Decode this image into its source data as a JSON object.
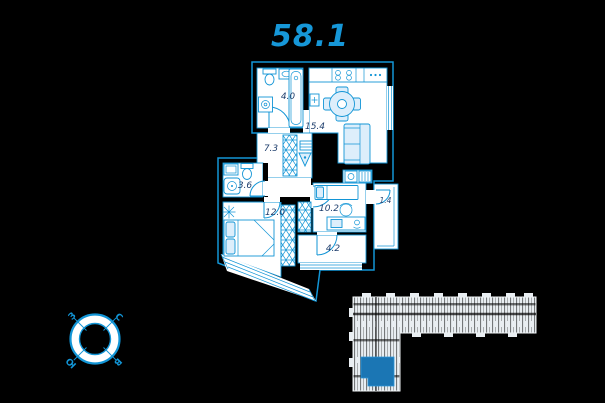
{
  "title": {
    "total_area": "58.1"
  },
  "plan": {
    "rooms": [
      {
        "name": "bathroom",
        "area": "4.0"
      },
      {
        "name": "kitchen-living-room",
        "area": "15.4"
      },
      {
        "name": "hallway",
        "area": "7.3"
      },
      {
        "name": "wc",
        "area": "3.6"
      },
      {
        "name": "bedroom",
        "area": "12.0"
      },
      {
        "name": "bedroom-2",
        "area": "10.2"
      },
      {
        "name": "balcony",
        "area": "1.4"
      },
      {
        "name": "loggia",
        "area": "4.2"
      }
    ],
    "fixtures": [
      "washing-machine",
      "toilet",
      "sink",
      "bathtub",
      "stove",
      "fridge",
      "water-heater",
      "dining-table",
      "chairs",
      "sofa",
      "wardrobe",
      "shelving",
      "fire-safety-sign",
      "washbasin",
      "shower-tray",
      "double-bed",
      "plant",
      "single-bed",
      "desk",
      "desk-chair",
      "laptop",
      "telephone",
      "radiator"
    ]
  },
  "compass": {
    "north": "С",
    "east": "В",
    "south": "Ю",
    "west": "З"
  },
  "colors": {
    "background": "#000000",
    "line_accent": "#1295d6",
    "room_fill": "#ffffff",
    "furniture_fill": "#ddeefb",
    "label_text": "#21406e",
    "highlight_unit": "#1b76b4",
    "key_plan_fill": "#e9eef2"
  }
}
